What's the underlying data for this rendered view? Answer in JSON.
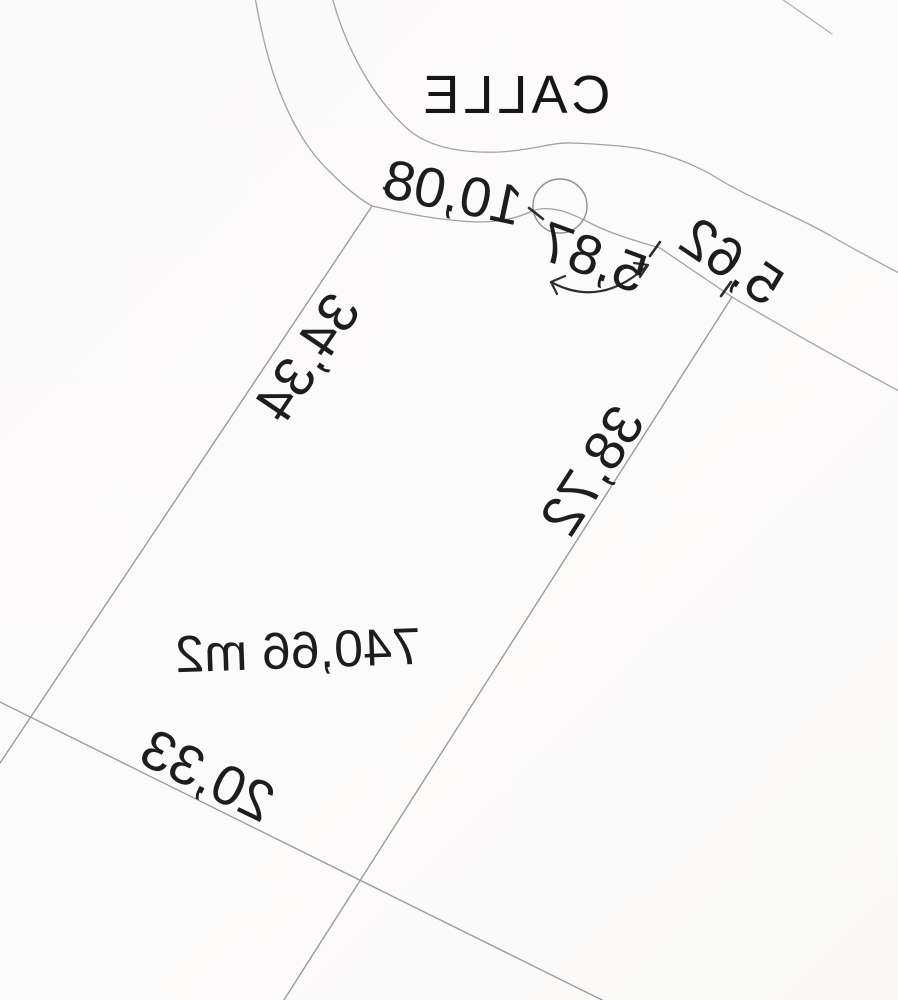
{
  "plan": {
    "street_label": "CALLE",
    "area_label": "740,66 m2",
    "dimensions": {
      "frontage_segment_1": "10,08",
      "frontage_curve": "5,87",
      "frontage_segment_2": "5,62",
      "side_a": "34,34",
      "side_b": "38,72",
      "rear": "20,33"
    },
    "colors": {
      "background": "#fbfafa",
      "line": "#9b9b9b",
      "text": "#1d1d1d"
    },
    "orientation_note": "mirrored"
  }
}
